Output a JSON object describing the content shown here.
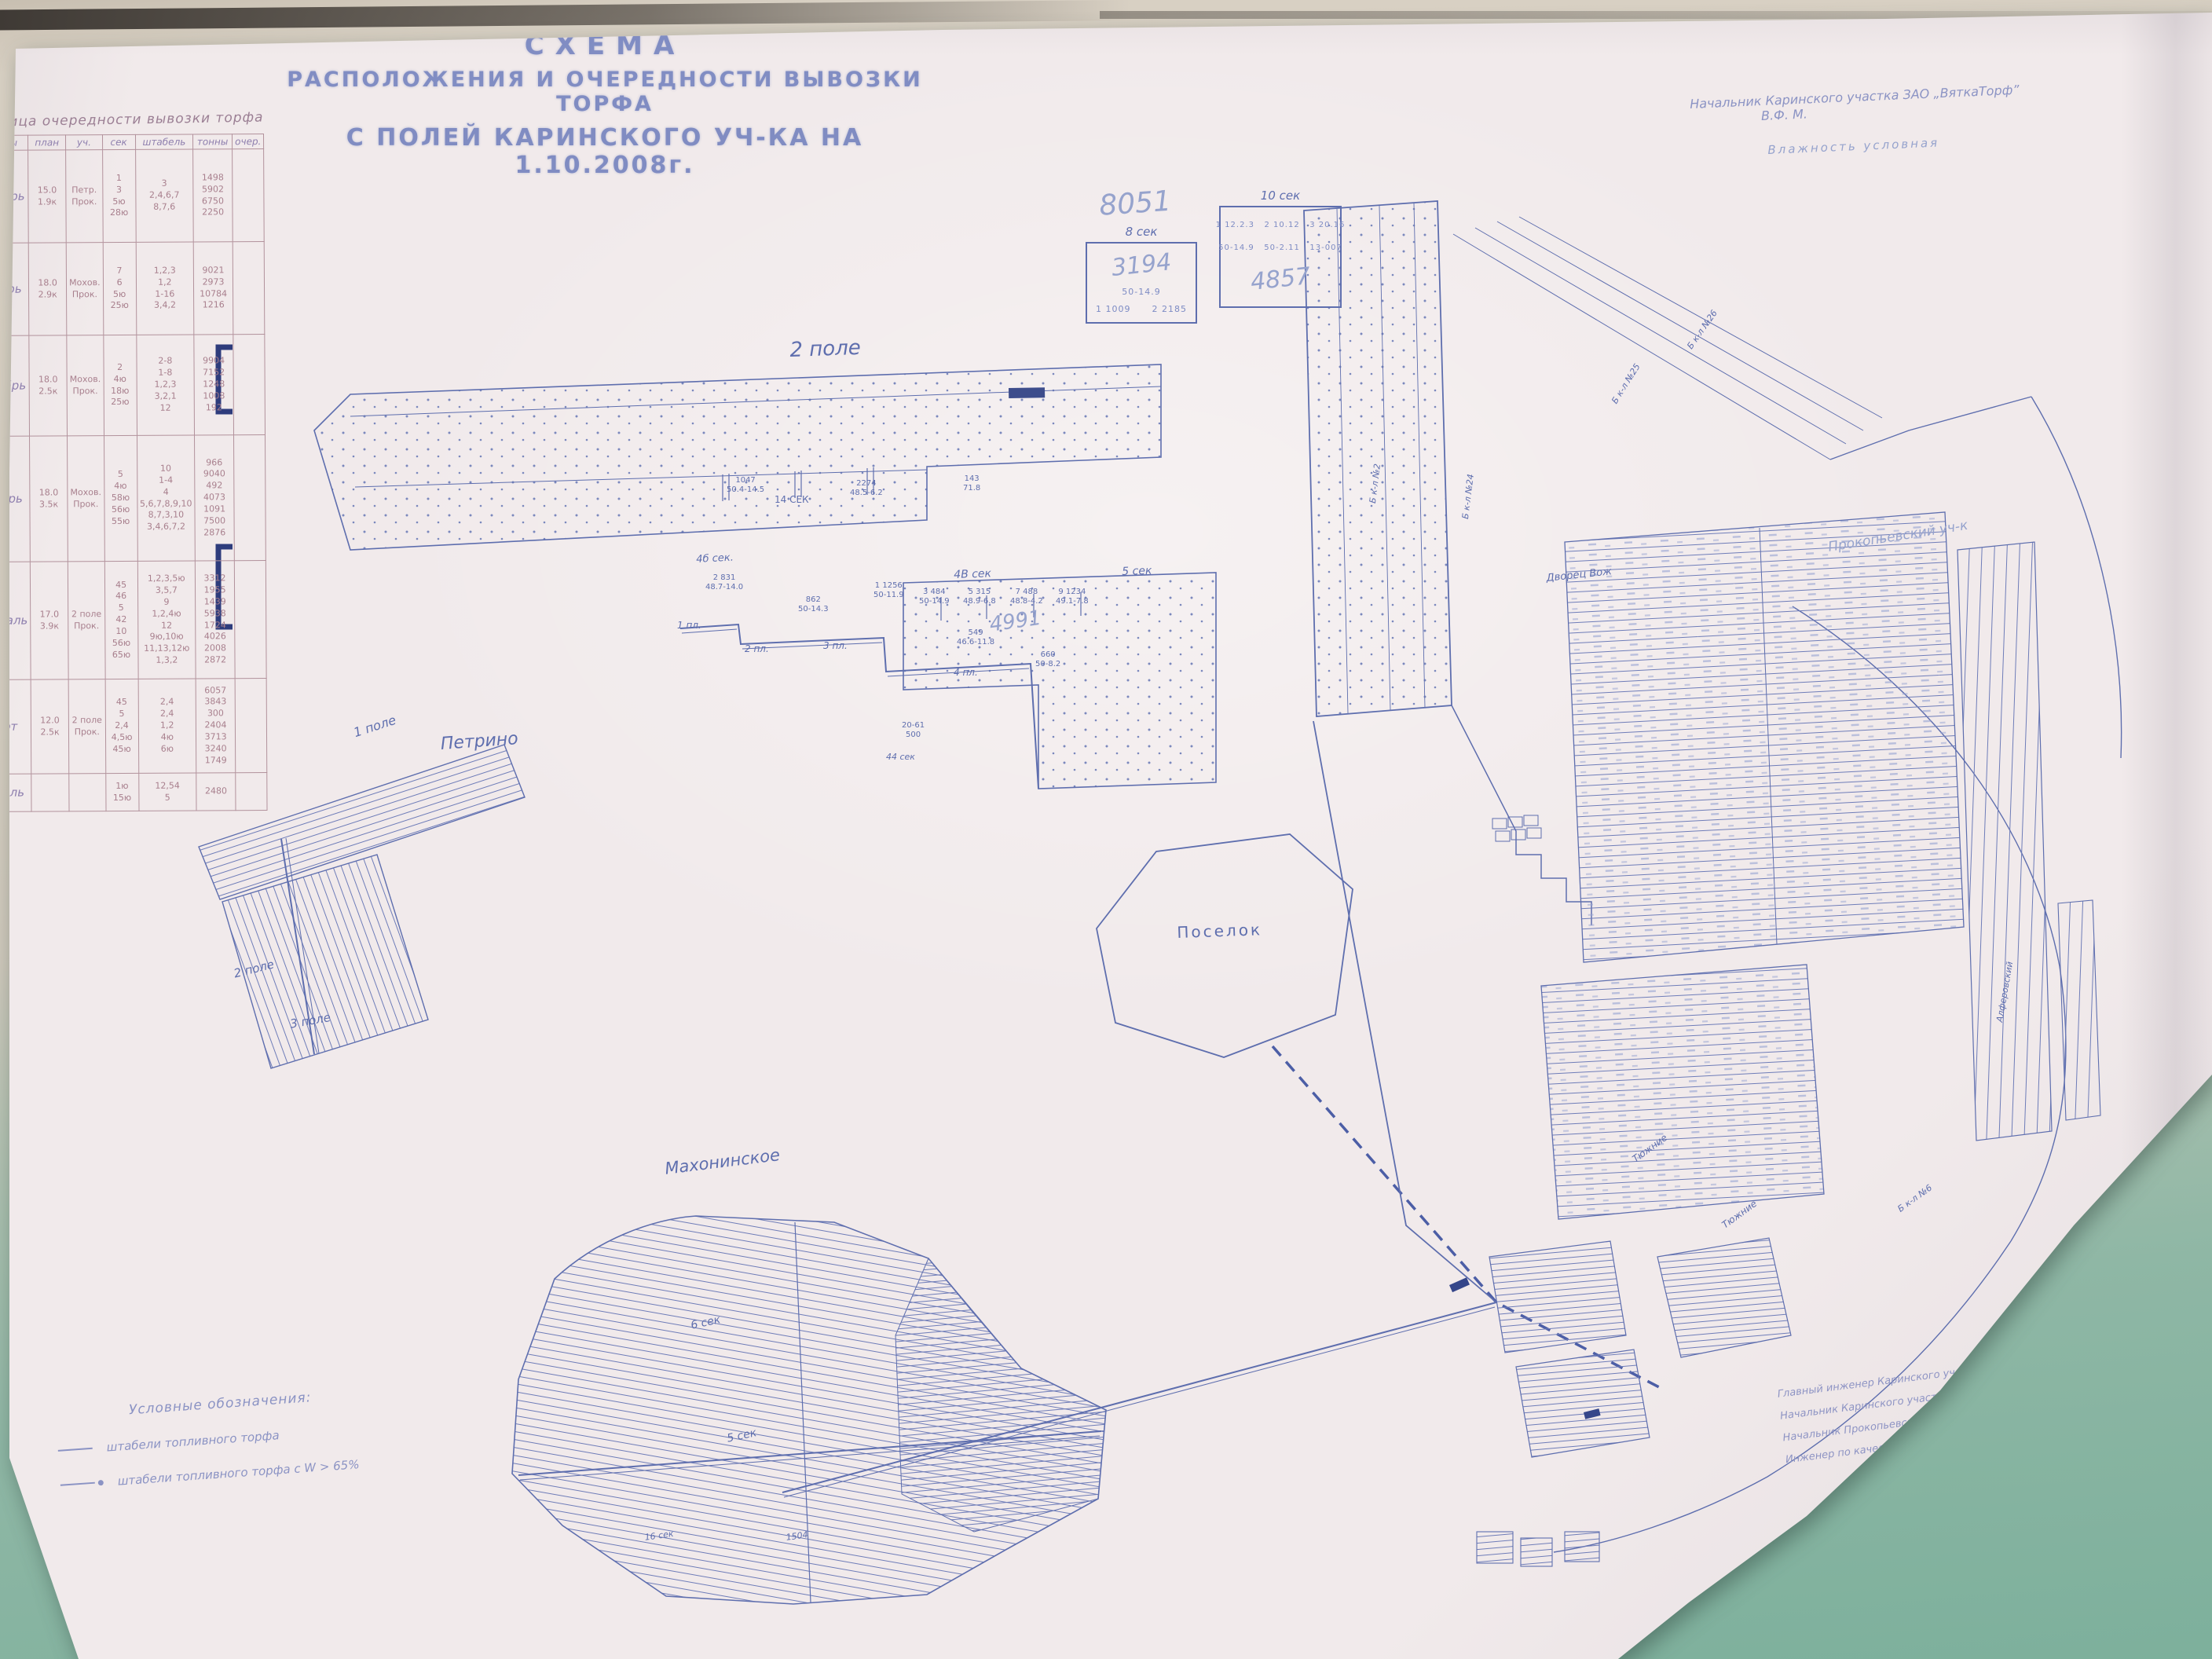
{
  "palette": {
    "wall_top": "#d7cfc2",
    "wall_bottom": "#7db09c",
    "paper": "#f1eaeb",
    "ink": "#5e6eae",
    "pencil": "#96a3cd",
    "table_grid": "#b2929c",
    "dark_mark": "#35468a"
  },
  "title": {
    "line1": "СХЕМА",
    "line2": "РАСПОЛОЖЕНИЯ И ОЧЕРЕДНОСТИ ВЫВОЗКИ ТОРФА",
    "line3": "С ПОЛЕЙ  КАРИНСКОГО  УЧ-КА  НА 1.10.2008г."
  },
  "top_note": {
    "line1": "Начальник Каринского участка ЗАО „ВяткаТорф”",
    "signature": "В.Ф. М.",
    "line2": "Влажность условная"
  },
  "order_table": {
    "title": "Таблица очередности вывозки торфа",
    "columns": [
      "месяцы",
      "план",
      "уч.",
      "сек",
      "штабель",
      "тонны",
      "очер."
    ],
    "rows": [
      {
        "month": "Октябрь",
        "plan": "15.0\n1.9к",
        "uch": "Петр.\nПрок.",
        "sek": "1\n3\n5ю\n28ю",
        "shtabel": "3\n2,4,6,7\n8,7,6",
        "tons": "1498\n5902\n6750\n2250",
        "extra": ""
      },
      {
        "month": "Ноябрь",
        "plan": "18.0\n2.9к",
        "uch": "Мохов.\nПрок.",
        "sek": "7\n6\n5ю\n25ю",
        "shtabel": "1,2,3\n1,2\n1-16\n3,4,2",
        "tons": "9021\n2973\n10784\n1216",
        "extra": ""
      },
      {
        "month": "Декабрь",
        "plan": "18.0\n2.5к",
        "uch": "Мохов.\nПрок.",
        "sek": "2\n4ю\n18ю\n25ю",
        "shtabel": "2-8\n1-8\n1,2,3\n3,2,1\n12",
        "tons": "9904\n7152\n1248\n1008\n192",
        "extra": ""
      },
      {
        "month": "Январь",
        "plan": "18.0\n3.5к",
        "uch": "Мохов.\nПрок.",
        "sek": "5\n4ю\n58ю\n56ю\n55ю",
        "shtabel": "10\n1-4\n4\n5,6,7,8,9,10\n8,7,3,10\n3,4,6,7,2",
        "tons": "966\n9040\n492\n4073\n1091\n7500\n2876",
        "extra": ""
      },
      {
        "month": "Февраль",
        "plan": "17.0\n3.9к",
        "uch": "2 поле\nПрок.",
        "sek": "45\n46\n5\n42\n10\n56ю\n65ю",
        "shtabel": "1,2,3,5ю\n3,5,7\n9\n1,2,4ю\n12\n9ю,10ю\n11,13,12ю\n1,3,2",
        "tons": "3312\n1955\n1439\n5938\n1724\n4026\n2008\n2872",
        "extra": ""
      },
      {
        "month": "Март",
        "plan": "12.0\n2.5к",
        "uch": "2 поле\nПрок.",
        "sek": "45\n5\n2,4\n4,5ю\n45ю",
        "shtabel": "2,4\n2,4\n1,2\n4ю\n6ю",
        "tons": "6057\n3843\n300\n2404\n3713\n3240\n1749",
        "extra": ""
      },
      {
        "month": "Апрель",
        "plan": "",
        "uch": "",
        "sek": "1ю\n15ю",
        "shtabel": "12,54\n5",
        "tons": "2480",
        "extra": ""
      }
    ]
  },
  "pencil_total": "8051",
  "stack_boxes": [
    {
      "label": "8 сек",
      "line_top": "3194",
      "line_mid": "50-14.9",
      "line_bottom": "1 1009      2 2185"
    },
    {
      "label": "10 сек",
      "line_top": "1 12.2.3   2 10.12   3 20.16",
      "line_mid": "50-14.9   50-2.11   13-007",
      "line_big": "4857"
    }
  ],
  "labels": [
    {
      "text": "2 поле"
    },
    {
      "text": "1 поле"
    },
    {
      "text": "Петрино"
    },
    {
      "text": "2 поле"
    },
    {
      "text": "3 поле"
    },
    {
      "text": "Махонинское"
    },
    {
      "text": "Поселок"
    },
    {
      "text": "Прокопьевский уч-к"
    },
    {
      "text": "6 сек"
    },
    {
      "text": "5 сек"
    },
    {
      "text": "16 сек"
    },
    {
      "text": "1504"
    },
    {
      "text": "4б сек."
    },
    {
      "text": "4В сек"
    },
    {
      "text": "5 сек"
    },
    {
      "text": "14 СЕК"
    },
    {
      "text": "1047\n50.4-14.5"
    },
    {
      "text": "2274\n48.5-6.2"
    },
    {
      "text": "143\n71.8"
    },
    {
      "text": "2 831\n48.7-14.0"
    },
    {
      "text": "862\n50-14.3"
    },
    {
      "text": "1 1256\n50-11.9"
    },
    {
      "text": "3 484\n50-14.9"
    },
    {
      "text": "5 315\n48.9-6.8"
    },
    {
      "text": "7 488\n48.8-4.2"
    },
    {
      "text": "9 1234\n49.1-7.8"
    },
    {
      "text": "4991"
    },
    {
      "text": "549\n46.6-11.8"
    },
    {
      "text": "660\n50-8.2"
    },
    {
      "text": "1 пл."
    },
    {
      "text": "2 пл."
    },
    {
      "text": "3 пл."
    },
    {
      "text": "4 пл."
    },
    {
      "text": "20-61\n500"
    },
    {
      "text": "44 сек"
    },
    {
      "text": "Б к-л №2"
    },
    {
      "text": "Б к-л №24"
    },
    {
      "text": "Б к-л №25"
    },
    {
      "text": "Б к-л №26"
    },
    {
      "text": "Дворец Вож"
    },
    {
      "text": "Тюжние"
    },
    {
      "text": "Тюжние"
    },
    {
      "text": "Б к-л №6"
    },
    {
      "text": "Алферовский"
    }
  ],
  "legend": {
    "title": "Условные обозначения:",
    "item1": "штабели  топливного  торфа",
    "item2": "штабели топливного  торфа с W > 65%"
  },
  "signatures": {
    "row1_role": "Главный инженер Каринского участка",
    "row1_name": "Н.А. Рыжков",
    "row2_role": "Начальник Каринского участка по добыче торфа",
    "row2_name": "В.В. Зайцев",
    "row3_role": "Начальник Прокопьевского участка по добыче торфа",
    "row3_name": "И.Н. Ушин",
    "row4_role": "Инженер по качеству",
    "row4_name": ""
  }
}
